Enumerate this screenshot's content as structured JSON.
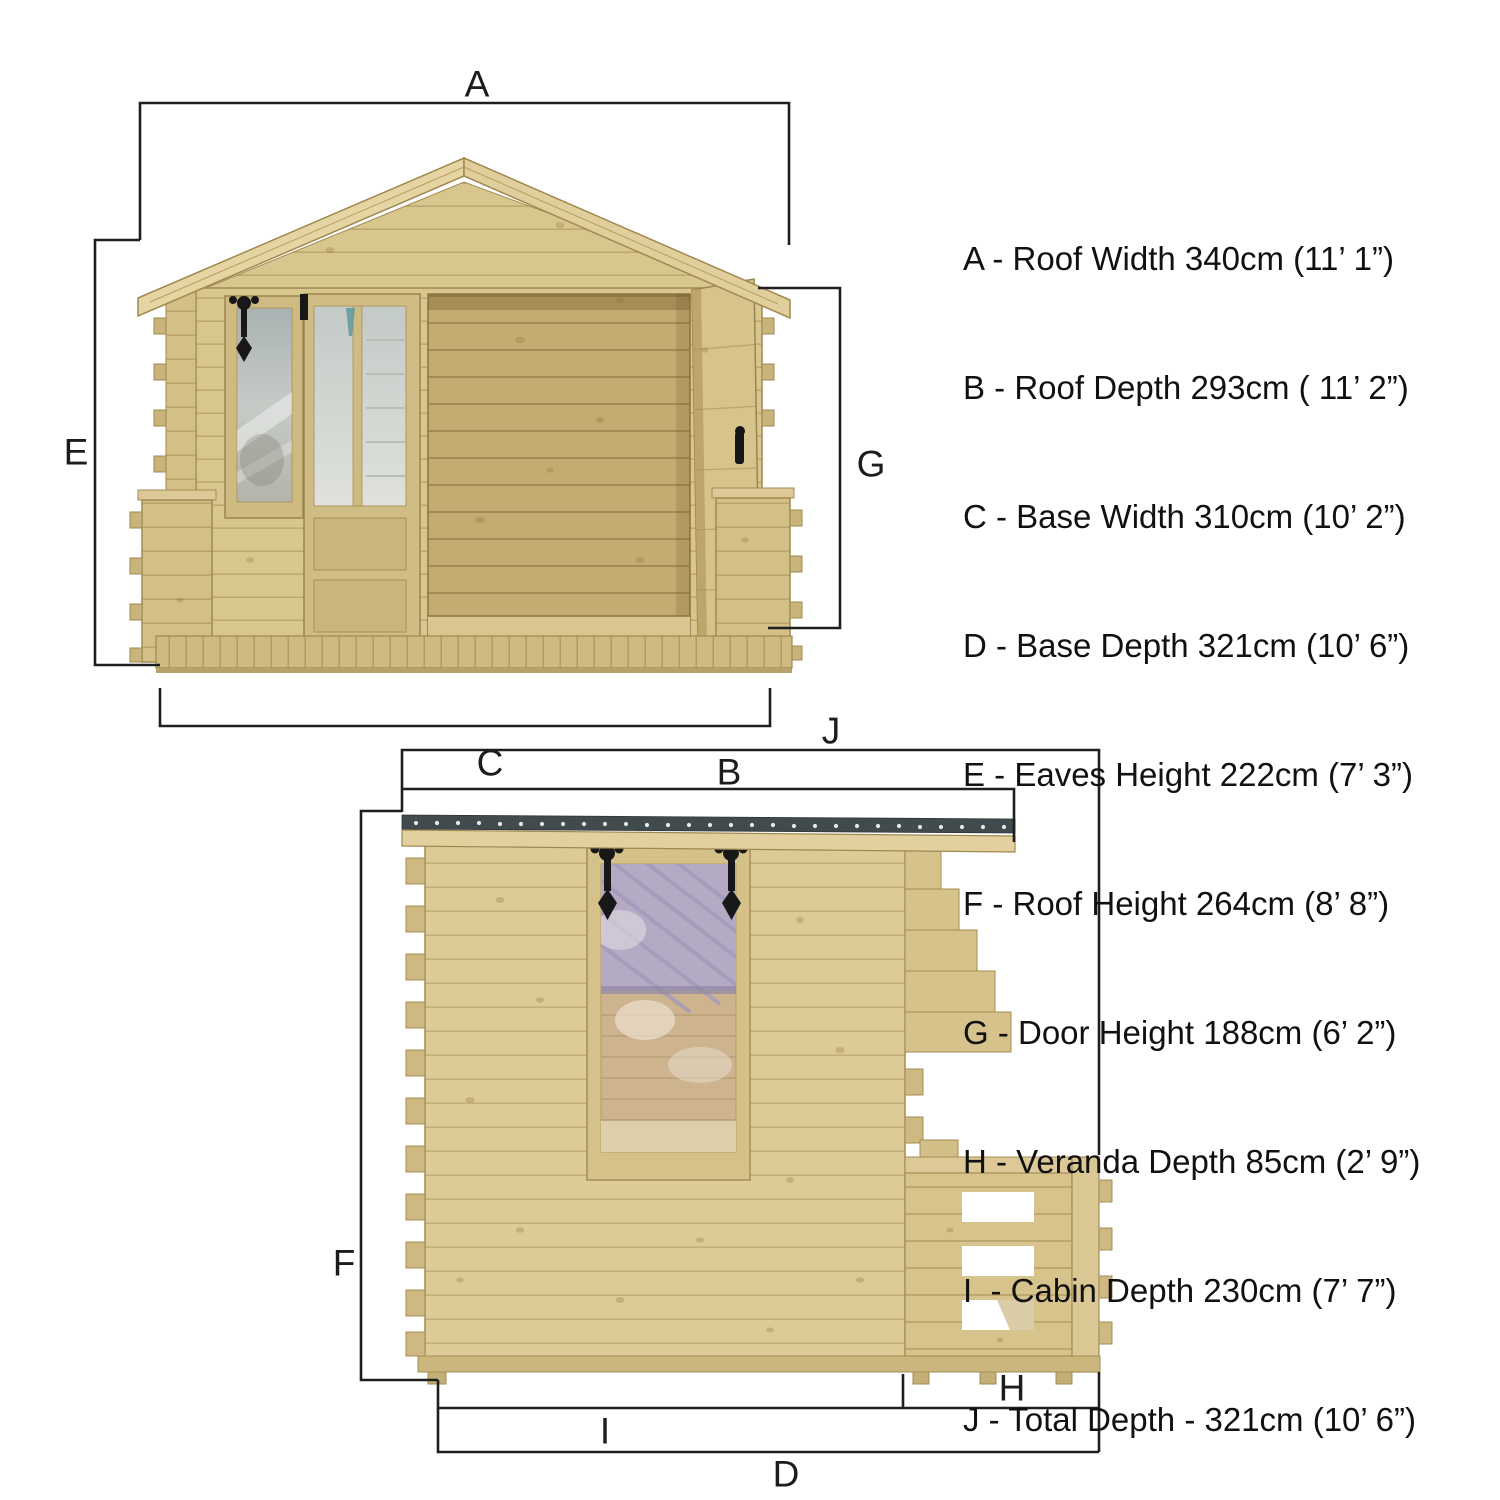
{
  "page": {
    "description": "Log cabin with veranda - dimensioned front and side elevation diagram",
    "background": "#ffffff"
  },
  "labels": {
    "a": "A",
    "b": "B",
    "c": "C",
    "d": "D",
    "e": "E",
    "f": "F",
    "g": "G",
    "h": "H",
    "i": "I",
    "j": "J"
  },
  "legend": {
    "items": [
      {
        "letter": "A",
        "dimension": "Roof Width",
        "metric": "340cm",
        "imperial": "11’ 1”",
        "text": "A - Roof Width 340cm (11’ 1”)"
      },
      {
        "letter": "B",
        "dimension": "Roof Depth",
        "metric": "293cm",
        "imperial": "11’ 2”",
        "text": "B - Roof Depth 293cm ( 11’ 2”)"
      },
      {
        "letter": "C",
        "dimension": "Base Width",
        "metric": "310cm",
        "imperial": "10’ 2”",
        "text": "C - Base Width 310cm (10’ 2”)"
      },
      {
        "letter": "D",
        "dimension": "Base Depth",
        "metric": "321cm",
        "imperial": "10’ 6”",
        "text": "D - Base Depth 321cm (10’ 6”)"
      },
      {
        "letter": "E",
        "dimension": "Eaves Height",
        "metric": "222cm",
        "imperial": "7’ 3”",
        "text": "E - Eaves Height 222cm (7’ 3”)"
      },
      {
        "letter": "F",
        "dimension": "Roof Height",
        "metric": "264cm",
        "imperial": "8’ 8”",
        "text": "F - Roof Height 264cm (8’ 8”)"
      },
      {
        "letter": "G",
        "dimension": "Door Height",
        "metric": "188cm",
        "imperial": "6’ 2”",
        "text": "G - Door Height 188cm (6’ 2”)"
      },
      {
        "letter": "H",
        "dimension": "Veranda Depth",
        "metric": "85cm",
        "imperial": "2’ 9”",
        "text": "H - Veranda Depth 85cm (2’ 9”)"
      },
      {
        "letter": "I",
        "dimension": "Cabin Depth",
        "metric": "230cm",
        "imperial": "7’ 7”",
        "text": "I  - Cabin Depth 230cm (7’ 7”)"
      },
      {
        "letter": "J",
        "dimension": "Total Depth",
        "metric": "321cm",
        "imperial": "10’ 6”",
        "text": "J - Total Depth - 321cm (10’ 6”)"
      }
    ]
  },
  "colors": {
    "wood_light": "#dccb99",
    "wood_mid": "#d2bf87",
    "wood_interior": "#c5ab71",
    "wood_line": "#a68c55",
    "roof_felt": "#414b4d",
    "glass": "#b6bdbc",
    "hardware_black": "#181818",
    "dimension_line": "#1f1f1f",
    "background": "#ffffff"
  }
}
